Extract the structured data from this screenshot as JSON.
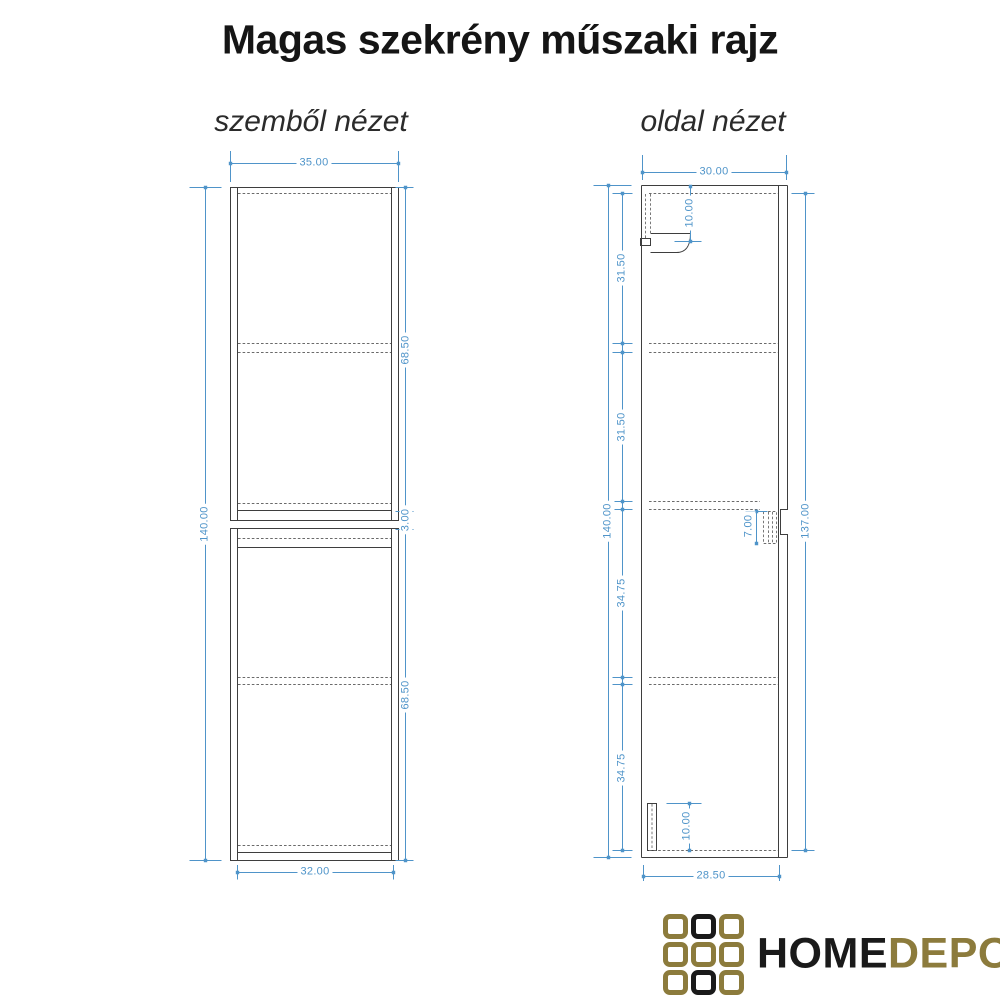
{
  "title": "Magas szekrény műszaki rajz",
  "views": {
    "front": {
      "label": "szemből nézet",
      "dims": {
        "width_top": "35.00",
        "width_bottom": "32.00",
        "height_total": "140.00",
        "upper_section": "68.50",
        "middle_gap": "3.00",
        "lower_section": "68.50"
      }
    },
    "side": {
      "label": "oldal nézet",
      "dims": {
        "depth_top": "30.00",
        "depth_bottom": "28.50",
        "height_total": "140.00",
        "segment_1": "31.50",
        "segment_2": "31.50",
        "segment_3": "34.75",
        "segment_4": "34.75",
        "front_panel_height": "137.00",
        "bracket_offset": "10.00",
        "notch_depth": "7.00",
        "plinth_height": "10.00"
      }
    }
  },
  "logo": {
    "word_primary": "HOME",
    "word_secondary": "DEPO",
    "grid_pattern": [
      [
        "gold",
        "black",
        "gold"
      ],
      [
        "gold",
        "gold",
        "gold"
      ],
      [
        "gold",
        "black",
        "gold"
      ]
    ]
  },
  "colors": {
    "dimension_blue": "#4f94c9",
    "line_dark": "#3e3e3e",
    "logo_gold": "#8c7b3c",
    "logo_black": "#1a1a1a"
  }
}
